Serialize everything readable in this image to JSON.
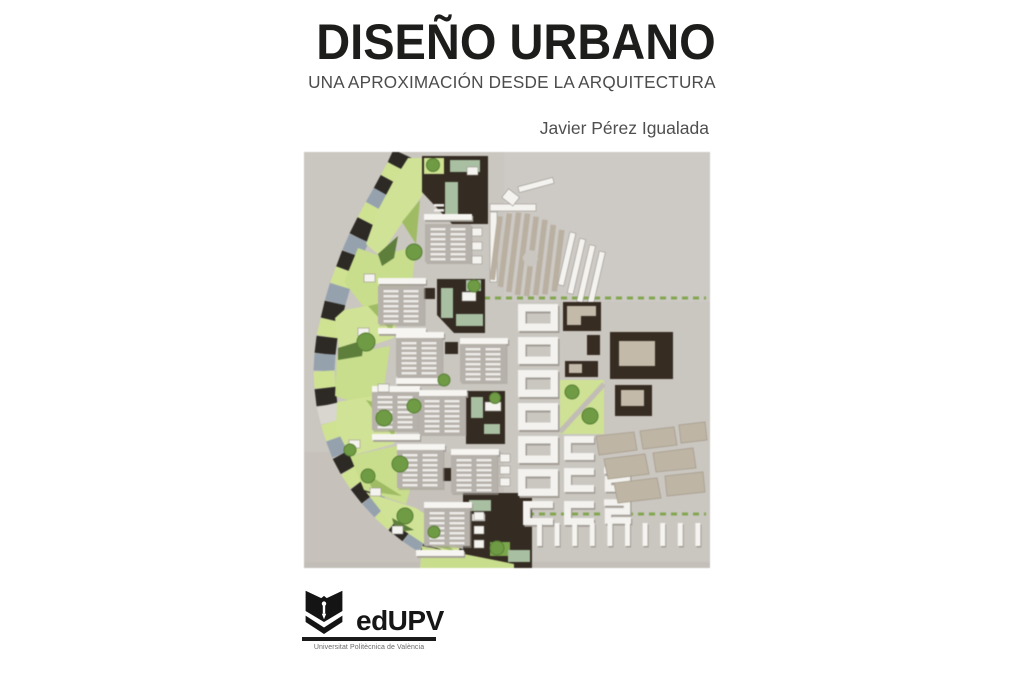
{
  "cover": {
    "title": "DISEÑO URBANO",
    "subtitle": "UNA APROXIMACIÓN DESDE LA ARQUITECTURA",
    "author": "Javier Pérez Igualada",
    "publisher": {
      "name": "edUPV",
      "tagline": "Universitat Politècnica de València"
    },
    "photo_alt": "aerial-photo-of-architectural-scale-model-of-urban-masterplan",
    "colors": {
      "title_text": "#1d1d1b",
      "secondary_text": "#4c4c4c",
      "logo_black": "#1a1a1a",
      "model_background": "#cac6c0",
      "model_light_green": "#cfe292",
      "model_dark_building": "#342b22",
      "model_blue_gray": "#95a2ae",
      "model_sage_roof": "#a9bfa2",
      "model_white_building": "#f3f2ee"
    }
  }
}
